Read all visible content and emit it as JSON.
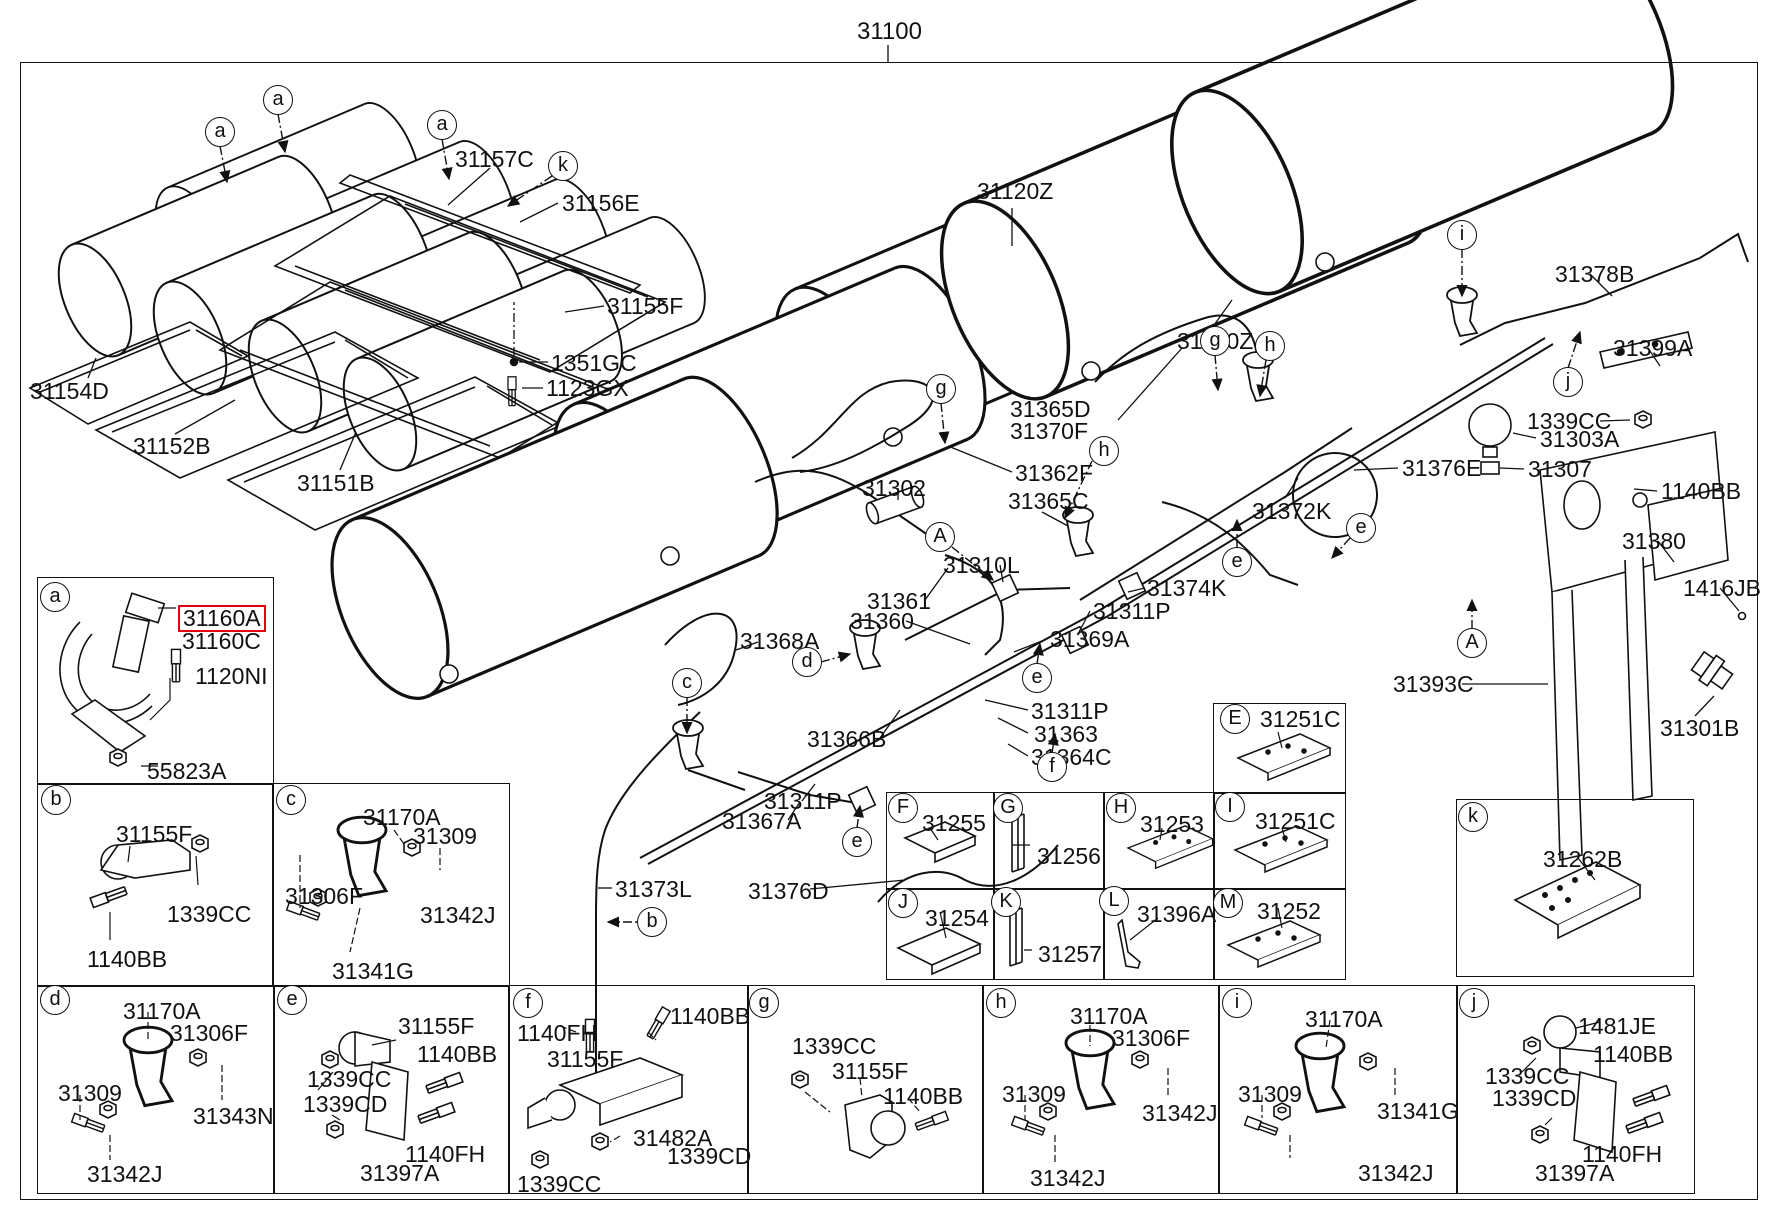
{
  "title": "31100",
  "colors": {
    "line": "#111111",
    "background": "#ffffff",
    "highlight_border": "#e60012"
  },
  "diagram": {
    "labels": [
      {
        "text": "31157C",
        "x": 455,
        "y": 148
      },
      {
        "text": "31156E",
        "x": 562,
        "y": 192
      },
      {
        "text": "31155F",
        "x": 607,
        "y": 295
      },
      {
        "text": "1351GC",
        "x": 551,
        "y": 352
      },
      {
        "text": "1123GX",
        "x": 546,
        "y": 377
      },
      {
        "text": "31154D",
        "x": 30,
        "y": 380
      },
      {
        "text": "31152B",
        "x": 133,
        "y": 435
      },
      {
        "text": "31151B",
        "x": 297,
        "y": 472
      },
      {
        "text": "31120Z",
        "x": 977,
        "y": 180
      },
      {
        "text": "31120Z",
        "x": 1177,
        "y": 330
      },
      {
        "text": "31365D",
        "x": 1010,
        "y": 398
      },
      {
        "text": "31370F",
        "x": 1010,
        "y": 420
      },
      {
        "text": "31362F",
        "x": 1015,
        "y": 462
      },
      {
        "text": "31302",
        "x": 862,
        "y": 477
      },
      {
        "text": "31365C",
        "x": 1008,
        "y": 490
      },
      {
        "text": "31310L",
        "x": 943,
        "y": 554
      },
      {
        "text": "31361",
        "x": 867,
        "y": 590
      },
      {
        "text": "31360",
        "x": 850,
        "y": 610
      },
      {
        "text": "31374K",
        "x": 1147,
        "y": 577
      },
      {
        "text": "31311P",
        "x": 1093,
        "y": 600
      },
      {
        "text": "31369A",
        "x": 1050,
        "y": 628
      },
      {
        "text": "31368A",
        "x": 740,
        "y": 630
      },
      {
        "text": "31311P",
        "x": 1031,
        "y": 700
      },
      {
        "text": "31363",
        "x": 1034,
        "y": 723
      },
      {
        "text": "31364C",
        "x": 1031,
        "y": 746
      },
      {
        "text": "31366B",
        "x": 807,
        "y": 728
      },
      {
        "text": "31311P",
        "x": 764,
        "y": 790
      },
      {
        "text": "31367A",
        "x": 722,
        "y": 810
      },
      {
        "text": "31373L",
        "x": 615,
        "y": 878
      },
      {
        "text": "31376D",
        "x": 748,
        "y": 880
      },
      {
        "text": "31378B",
        "x": 1555,
        "y": 263
      },
      {
        "text": "31399A",
        "x": 1613,
        "y": 337
      },
      {
        "text": "1339CC",
        "x": 1527,
        "y": 410
      },
      {
        "text": "31303A",
        "x": 1540,
        "y": 428
      },
      {
        "text": "31376E",
        "x": 1402,
        "y": 457
      },
      {
        "text": "31307",
        "x": 1528,
        "y": 458
      },
      {
        "text": "1140BB",
        "x": 1661,
        "y": 480
      },
      {
        "text": "31372K",
        "x": 1252,
        "y": 500
      },
      {
        "text": "31380",
        "x": 1622,
        "y": 530
      },
      {
        "text": "1416JB",
        "x": 1683,
        "y": 577
      },
      {
        "text": "31393C",
        "x": 1393,
        "y": 673
      },
      {
        "text": "31301B",
        "x": 1660,
        "y": 717
      },
      {
        "text": "31160A",
        "x": 182,
        "y": 608,
        "h": true
      },
      {
        "text": "31160C",
        "x": 182,
        "y": 630
      },
      {
        "text": "1120NI",
        "x": 195,
        "y": 665
      },
      {
        "text": "55823A",
        "x": 147,
        "y": 760
      },
      {
        "text": "31155F",
        "x": 116,
        "y": 823
      },
      {
        "text": "1339CC",
        "x": 167,
        "y": 903
      },
      {
        "text": "1140BB",
        "x": 87,
        "y": 948
      },
      {
        "text": "31170A",
        "x": 363,
        "y": 806
      },
      {
        "text": "31309",
        "x": 413,
        "y": 825
      },
      {
        "text": "31306F",
        "x": 285,
        "y": 885
      },
      {
        "text": "31342J",
        "x": 420,
        "y": 904
      },
      {
        "text": "31341G",
        "x": 332,
        "y": 960
      },
      {
        "text": "31170A",
        "x": 123,
        "y": 1000
      },
      {
        "text": "31306F",
        "x": 170,
        "y": 1022
      },
      {
        "text": "31309",
        "x": 58,
        "y": 1082
      },
      {
        "text": "31343N",
        "x": 193,
        "y": 1105
      },
      {
        "text": "31342J",
        "x": 87,
        "y": 1163
      },
      {
        "text": "31155F",
        "x": 398,
        "y": 1015
      },
      {
        "text": "1140BB",
        "x": 417,
        "y": 1043
      },
      {
        "text": "1339CC",
        "x": 307,
        "y": 1068
      },
      {
        "text": "1339CD",
        "x": 303,
        "y": 1093
      },
      {
        "text": "1140FH",
        "x": 405,
        "y": 1143
      },
      {
        "text": "31397A",
        "x": 360,
        "y": 1162
      },
      {
        "text": "1140FH",
        "x": 517,
        "y": 1022
      },
      {
        "text": "1140BB",
        "x": 670,
        "y": 1005
      },
      {
        "text": "31155F",
        "x": 547,
        "y": 1048
      },
      {
        "text": "31482A",
        "x": 633,
        "y": 1127
      },
      {
        "text": "1339CD",
        "x": 667,
        "y": 1145
      },
      {
        "text": "1339CC",
        "x": 517,
        "y": 1173
      },
      {
        "text": "1339CC",
        "x": 792,
        "y": 1035
      },
      {
        "text": "31155F",
        "x": 832,
        "y": 1060
      },
      {
        "text": "1140BB",
        "x": 883,
        "y": 1085
      },
      {
        "text": "31170A",
        "x": 1070,
        "y": 1005
      },
      {
        "text": "31306F",
        "x": 1112,
        "y": 1027
      },
      {
        "text": "31309",
        "x": 1002,
        "y": 1083
      },
      {
        "text": "31342J",
        "x": 1142,
        "y": 1102
      },
      {
        "text": "31342J",
        "x": 1030,
        "y": 1167
      },
      {
        "text": "31170A",
        "x": 1305,
        "y": 1008
      },
      {
        "text": "31309",
        "x": 1238,
        "y": 1083
      },
      {
        "text": "31341G",
        "x": 1377,
        "y": 1100
      },
      {
        "text": "31342J",
        "x": 1358,
        "y": 1162
      },
      {
        "text": "1481JE",
        "x": 1578,
        "y": 1015
      },
      {
        "text": "1140BB",
        "x": 1593,
        "y": 1043
      },
      {
        "text": "1339CC",
        "x": 1485,
        "y": 1065
      },
      {
        "text": "1339CD",
        "x": 1492,
        "y": 1087
      },
      {
        "text": "1140FH",
        "x": 1582,
        "y": 1143
      },
      {
        "text": "31397A",
        "x": 1535,
        "y": 1162
      },
      {
        "text": "31262B",
        "x": 1543,
        "y": 848
      },
      {
        "text": "31251C",
        "x": 1260,
        "y": 708
      },
      {
        "text": "31255",
        "x": 922,
        "y": 812
      },
      {
        "text": "31256",
        "x": 1037,
        "y": 845
      },
      {
        "text": "31253",
        "x": 1140,
        "y": 813
      },
      {
        "text": "31251C",
        "x": 1255,
        "y": 810
      },
      {
        "text": "31254",
        "x": 925,
        "y": 907
      },
      {
        "text": "31257",
        "x": 1038,
        "y": 943
      },
      {
        "text": "31396A",
        "x": 1137,
        "y": 903
      },
      {
        "text": "31252",
        "x": 1257,
        "y": 900
      }
    ],
    "callouts": [
      {
        "letter": "a",
        "x": 220,
        "y": 132
      },
      {
        "letter": "a",
        "x": 278,
        "y": 100
      },
      {
        "letter": "a",
        "x": 442,
        "y": 125
      },
      {
        "letter": "k",
        "x": 563,
        "y": 166
      },
      {
        "letter": "g",
        "x": 941,
        "y": 389
      },
      {
        "letter": "h",
        "x": 1104,
        "y": 451
      },
      {
        "letter": "g",
        "x": 1215,
        "y": 341
      },
      {
        "letter": "h",
        "x": 1270,
        "y": 346
      },
      {
        "letter": "i",
        "x": 1462,
        "y": 235
      },
      {
        "letter": "j",
        "x": 1568,
        "y": 382
      },
      {
        "letter": "e",
        "x": 1361,
        "y": 528
      },
      {
        "letter": "e",
        "x": 1237,
        "y": 562
      },
      {
        "letter": "e",
        "x": 1037,
        "y": 678
      },
      {
        "letter": "e",
        "x": 857,
        "y": 842
      },
      {
        "letter": "A",
        "x": 940,
        "y": 537
      },
      {
        "letter": "A",
        "x": 1472,
        "y": 643
      },
      {
        "letter": "c",
        "x": 687,
        "y": 683
      },
      {
        "letter": "d",
        "x": 807,
        "y": 662
      },
      {
        "letter": "f",
        "x": 1052,
        "y": 767
      },
      {
        "letter": "b",
        "x": 652,
        "y": 922
      },
      {
        "letter": "a",
        "x": 55,
        "y": 597
      },
      {
        "letter": "b",
        "x": 56,
        "y": 800
      },
      {
        "letter": "c",
        "x": 291,
        "y": 800
      },
      {
        "letter": "d",
        "x": 55,
        "y": 1000
      },
      {
        "letter": "e",
        "x": 292,
        "y": 1000
      },
      {
        "letter": "f",
        "x": 528,
        "y": 1003
      },
      {
        "letter": "g",
        "x": 764,
        "y": 1003
      },
      {
        "letter": "h",
        "x": 1001,
        "y": 1003
      },
      {
        "letter": "i",
        "x": 1237,
        "y": 1003
      },
      {
        "letter": "j",
        "x": 1474,
        "y": 1003
      },
      {
        "letter": "k",
        "x": 1473,
        "y": 817
      },
      {
        "letter": "E",
        "x": 1235,
        "y": 719
      },
      {
        "letter": "F",
        "x": 903,
        "y": 808
      },
      {
        "letter": "G",
        "x": 1008,
        "y": 808
      },
      {
        "letter": "H",
        "x": 1121,
        "y": 808
      },
      {
        "letter": "I",
        "x": 1230,
        "y": 807
      },
      {
        "letter": "J",
        "x": 903,
        "y": 903
      },
      {
        "letter": "K",
        "x": 1006,
        "y": 902
      },
      {
        "letter": "L",
        "x": 1114,
        "y": 901
      },
      {
        "letter": "M",
        "x": 1228,
        "y": 903
      }
    ],
    "boxes": [
      {
        "x": 37,
        "y": 577,
        "w": 235,
        "h": 206
      },
      {
        "x": 37,
        "y": 783,
        "w": 235,
        "h": 202
      },
      {
        "x": 272,
        "y": 783,
        "w": 236,
        "h": 202
      },
      {
        "x": 37,
        "y": 985,
        "w": 236,
        "h": 207
      },
      {
        "x": 273,
        "y": 985,
        "w": 235,
        "h": 207
      },
      {
        "x": 508,
        "y": 985,
        "w": 239,
        "h": 207
      },
      {
        "x": 747,
        "y": 985,
        "w": 235,
        "h": 207
      },
      {
        "x": 982,
        "y": 985,
        "w": 236,
        "h": 207
      },
      {
        "x": 1218,
        "y": 985,
        "w": 238,
        "h": 207
      },
      {
        "x": 1456,
        "y": 985,
        "w": 237,
        "h": 207
      },
      {
        "x": 1456,
        "y": 799,
        "w": 236,
        "h": 176
      },
      {
        "x": 1213,
        "y": 703,
        "w": 131,
        "h": 89
      },
      {
        "x": 886,
        "y": 792,
        "w": 107,
        "h": 96
      },
      {
        "x": 993,
        "y": 792,
        "w": 110,
        "h": 96
      },
      {
        "x": 1103,
        "y": 792,
        "w": 110,
        "h": 96
      },
      {
        "x": 1213,
        "y": 792,
        "w": 131,
        "h": 96
      },
      {
        "x": 886,
        "y": 888,
        "w": 107,
        "h": 90
      },
      {
        "x": 993,
        "y": 888,
        "w": 110,
        "h": 90
      },
      {
        "x": 1103,
        "y": 888,
        "w": 110,
        "h": 90
      },
      {
        "x": 1213,
        "y": 888,
        "w": 131,
        "h": 90
      }
    ]
  }
}
